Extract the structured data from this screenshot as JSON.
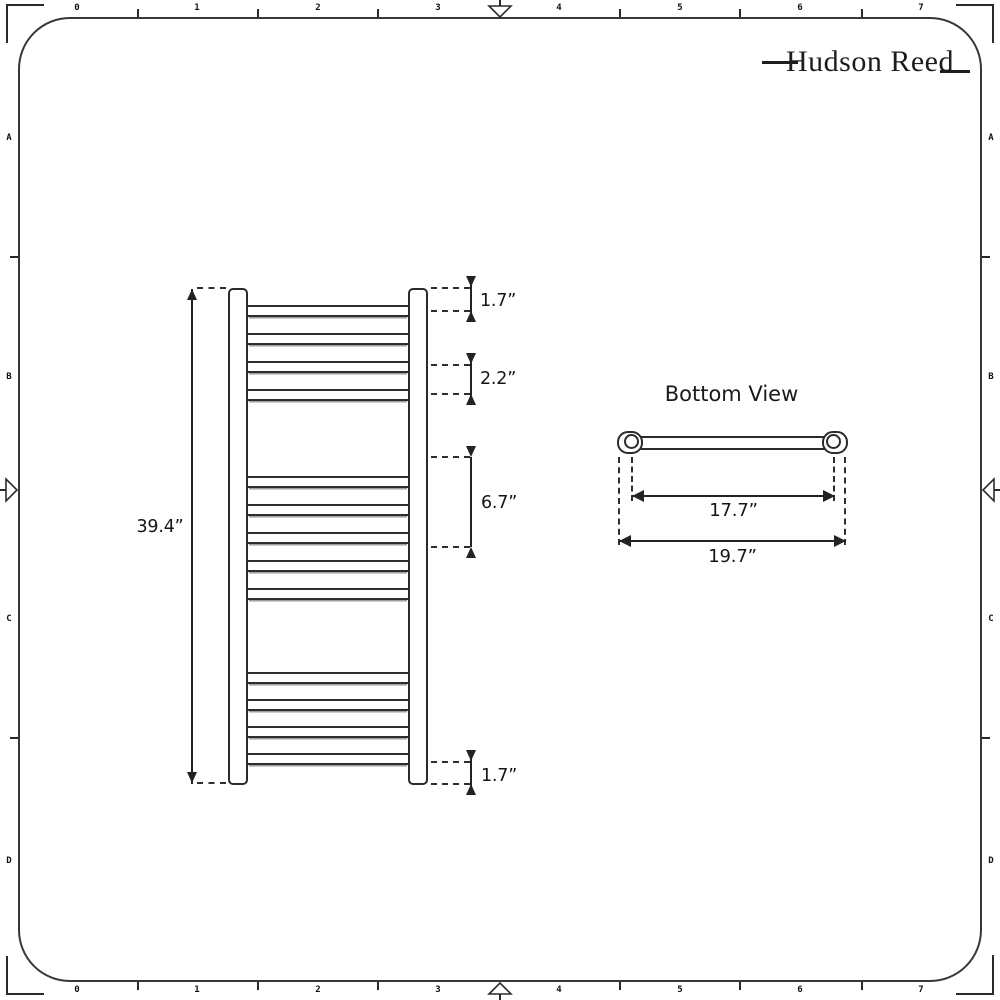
{
  "sheet": {
    "background": "#ffffff",
    "ink": "#232323"
  },
  "brand": {
    "name": "Hudson Reed"
  },
  "rulers": {
    "top_numbers": [
      "0",
      "1",
      "2",
      "3",
      "4",
      "5",
      "6",
      "7"
    ],
    "bottom_numbers": [
      "0",
      "1",
      "2",
      "3",
      "4",
      "5",
      "6",
      "7"
    ],
    "left_letters": [
      "A",
      "B",
      "C",
      "D"
    ],
    "right_letters": [
      "A",
      "B",
      "C",
      "D"
    ]
  },
  "front_view": {
    "overall_height": "39.4”",
    "top_pitch": "1.7”",
    "rung_pitch": "2.2”",
    "mid_gap": "6.7”",
    "bottom_pitch": "1.7”",
    "tube_groups": [
      {
        "y": 305,
        "count": 4,
        "spacing": 28
      },
      {
        "y": 476,
        "count": 5,
        "spacing": 28
      },
      {
        "y": 672,
        "count": 4,
        "spacing": 27
      }
    ]
  },
  "bottom_view": {
    "title": "Bottom View",
    "fixing_centres": "17.7”",
    "overall_width": "19.7”"
  }
}
